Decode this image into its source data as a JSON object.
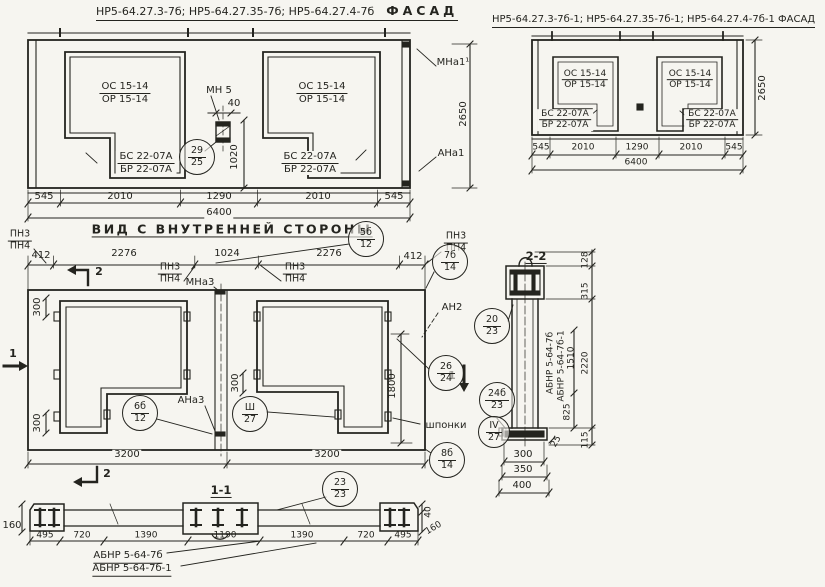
{
  "page": {
    "paper": "#f6f5f0",
    "ink": "#24241f"
  },
  "facade_left": {
    "title_codes": "НР5-64.27.3-7б; НР5-64.27.35-7б; НР5-64.27.4-7б",
    "title_word": "ФАСАД",
    "opening_top": "ОС 15-14",
    "opening_bot": "ОР 15-14",
    "block_top": "БС 22-07А",
    "block_bot": "БР 22-07А",
    "mn5": "МН 5",
    "dim40": "40",
    "dim1020": "1020",
    "c2925": {
      "top": "29",
      "bot": "25"
    },
    "dims": [
      "545",
      "2010",
      "1290",
      "2010",
      "545"
    ],
    "total": "6400",
    "mna1": "МНа1¹",
    "ana1": "АНа1",
    "dim2650": "2650"
  },
  "facade_right": {
    "title": "НР5-64.27.3-7б-1; НР5-64.27.35-7б-1; НР5-64.27.4-7б-1 ФАСАД",
    "opening_top": "ОС 15-14",
    "opening_bot": "ОР 15-14",
    "block_top": "БС 22-07А",
    "block_bot": "БР 22-07А",
    "dims": [
      "545",
      "2010",
      "1290",
      "2010",
      "545"
    ],
    "total": "6400",
    "dim2650": "2650"
  },
  "inner": {
    "title": "ВИД С ВНУТРЕННЕЙ СТОРОНЫ",
    "pn3": "ПН3",
    "pn4": "ПН4",
    "dims_top": [
      "412",
      "2276",
      "1024",
      "2276",
      "412"
    ],
    "mna3": "МНа3",
    "ana3": "АНа3",
    "an2": "АН2",
    "shponki": "шпонки",
    "dim300": "300",
    "dim1800": "1800",
    "dims_bottom": [
      "3200",
      "3200"
    ],
    "marker1": "1",
    "marker2": "2",
    "c5b12": {
      "top": "5б",
      "bot": "12"
    },
    "c7b14": {
      "top": "7б",
      "bot": "14"
    },
    "c6b12": {
      "top": "6б",
      "bot": "12"
    },
    "cIII27": {
      "top": "Ш",
      "bot": "27"
    },
    "c2624": {
      "top": "26",
      "bot": "24"
    },
    "c2023": {
      "top": "20",
      "bot": "23"
    },
    "c24b23": {
      "top": "24б",
      "bot": "23"
    },
    "cIV27": {
      "top": "IV",
      "bot": "27"
    },
    "c8b14": {
      "top": "8б",
      "bot": "14"
    }
  },
  "sec11": {
    "title": "1-1",
    "c2323": {
      "top": "23",
      "bot": "23"
    },
    "dim160l": "160",
    "dims": [
      "495",
      "720",
      "1390",
      "1190",
      "1390",
      "720",
      "495"
    ],
    "dim40": "40",
    "dim160r": "160",
    "label1": "АБНР 5-64-7б",
    "label2": "АБНР 5-64-7б-1"
  },
  "sec22": {
    "title": "2-2",
    "label1": "АБНР 5-64-7б",
    "label2": "АБНР 5-64-7б-1",
    "dim1510": "1510",
    "dim128": "128",
    "dim315": "315",
    "dim2220": "2220",
    "dim825": "825",
    "dim25": "25",
    "dim115": "115",
    "dims_bottom": [
      "300",
      "350",
      "400"
    ]
  }
}
